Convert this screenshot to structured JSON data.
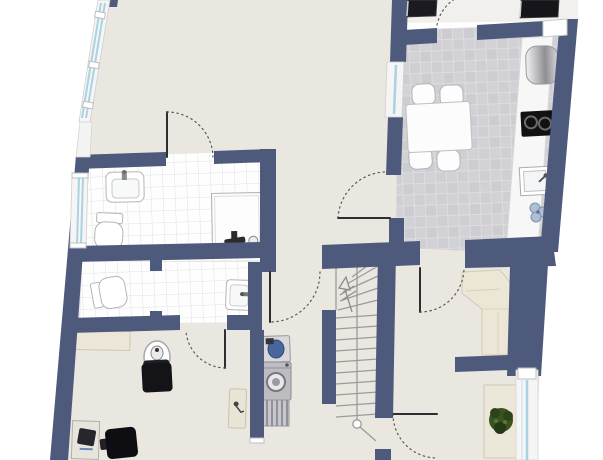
{
  "plan": {
    "type": "floor-plan",
    "colors": {
      "wall": "#4e5a7c",
      "floor": "#e9e7e0",
      "entry_floor": "#f1f0ec",
      "counter": "#f7f7f7",
      "window_frame": "#f5f5f5",
      "window_glass": "#a9d2e2",
      "door_leaf": "#2e2e30",
      "door_arc": "#5a5a5a",
      "furniture_white": "#fcfcfc",
      "furniture_cream": "#ebe6d5",
      "furniture_black": "#141418",
      "appliance_gray": "#bcbcc1",
      "radiator_gray": "#c7c7cc",
      "stair_line": "#9b9b9e",
      "plant_green": "#3a5321",
      "mat_black": "#1b1b1f",
      "basin_blue": "#49679c",
      "cooktop_black": "#111111"
    },
    "regions": [
      {
        "name": "living-area"
      },
      {
        "name": "kitchen"
      },
      {
        "name": "bathroom"
      },
      {
        "name": "wc"
      },
      {
        "name": "office-room"
      },
      {
        "name": "hallway"
      },
      {
        "name": "staircase"
      },
      {
        "name": "dining-nook"
      },
      {
        "name": "entry-landing"
      }
    ],
    "fixtures": [
      {
        "icon": "dining-table-icon"
      },
      {
        "icon": "chair-icon"
      },
      {
        "icon": "fridge-icon"
      },
      {
        "icon": "cooktop-icon"
      },
      {
        "icon": "kitchen-sink-icon"
      },
      {
        "icon": "flower-icon"
      },
      {
        "icon": "bath-sink-icon"
      },
      {
        "icon": "toilet-icon"
      },
      {
        "icon": "shower-icon"
      },
      {
        "icon": "wc-toilet-icon"
      },
      {
        "icon": "wc-sink-icon"
      },
      {
        "icon": "laundry-sink-icon"
      },
      {
        "icon": "washing-machine-icon"
      },
      {
        "icon": "radiator-icon"
      },
      {
        "icon": "round-table-icon"
      },
      {
        "icon": "armchair-icon"
      },
      {
        "icon": "desk-icon"
      },
      {
        "icon": "printer-icon"
      },
      {
        "icon": "office-chair-icon"
      },
      {
        "icon": "corner-bench-icon"
      },
      {
        "icon": "plant-icon"
      },
      {
        "icon": "stairs-up-arrow-icon"
      },
      {
        "icon": "doormat-icon"
      }
    ],
    "doors": 7,
    "windows": 4
  }
}
